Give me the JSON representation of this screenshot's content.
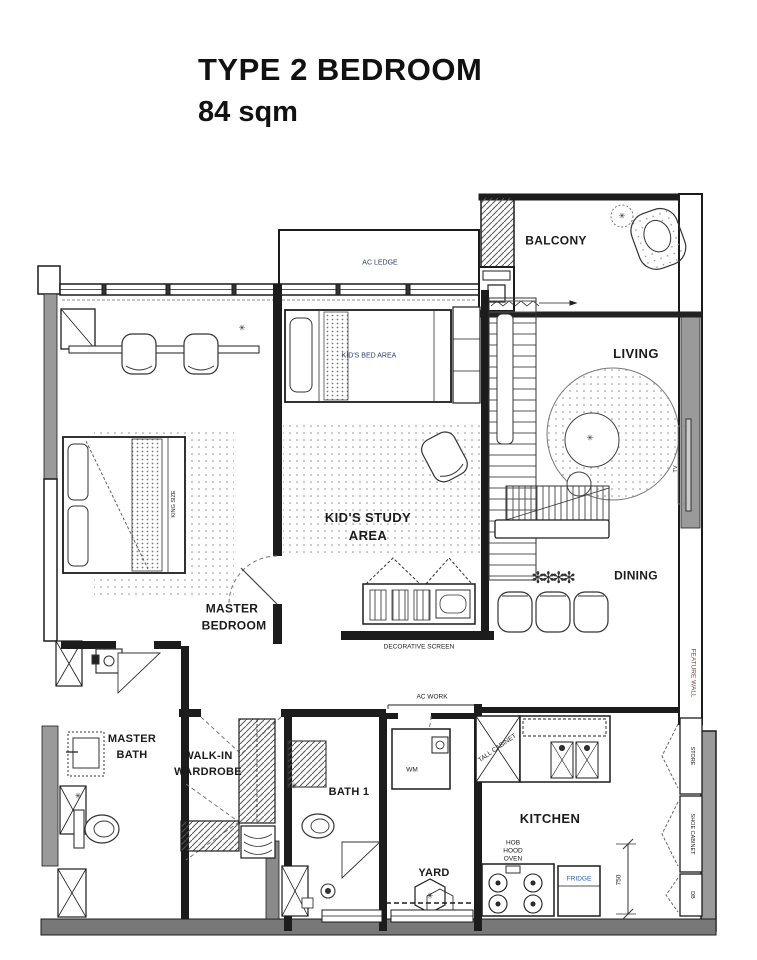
{
  "title": {
    "line1": "TYPE 2 BEDROOM",
    "line2": "84 sqm"
  },
  "rooms": {
    "balcony": "BALCONY",
    "ac_ledge": "AC LEDGE",
    "kids_bed_area": "KID'S BED AREA",
    "living": "LIVING",
    "kids_study_line1": "KID'S STUDY",
    "kids_study_line2": "AREA",
    "master_bedroom_line1": "MASTER",
    "master_bedroom_line2": "BEDROOM",
    "dining": "DINING",
    "master_bath_line1": "MASTER",
    "master_bath_line2": "BATH",
    "walkin_line1": "WALK-IN",
    "walkin_line2": "WARDROBE",
    "bath1": "BATH 1",
    "yard": "YARD",
    "kitchen": "KITCHEN"
  },
  "annotations": {
    "king_size": "KING SIZE",
    "decorative_screen": "DECORATIVE SCREEN",
    "ac_work": "AC WORK",
    "wm": "WM",
    "tall_cabinet": "TALL CABINET",
    "hob": "HOB",
    "hood": "HOOD",
    "oven": "OVEN",
    "fridge": "FRIDGE",
    "dim_750": "750",
    "feature_wall": "FEATURE WALL",
    "store": "STORE",
    "shoe_cabinet": "SHOE CABINET",
    "db": "DB",
    "tv": "TV"
  },
  "icons": {
    "plant": "✳",
    "plants_row": "✻✻✻✻",
    "drain": "✳"
  },
  "colors": {
    "wall": "#1c1c1c",
    "wall_gray": "#9a9a9a",
    "label": "#1b1b1b",
    "label_navy": "#27406e",
    "label_blue": "#1e5fae",
    "label_red": "#8a4038"
  }
}
